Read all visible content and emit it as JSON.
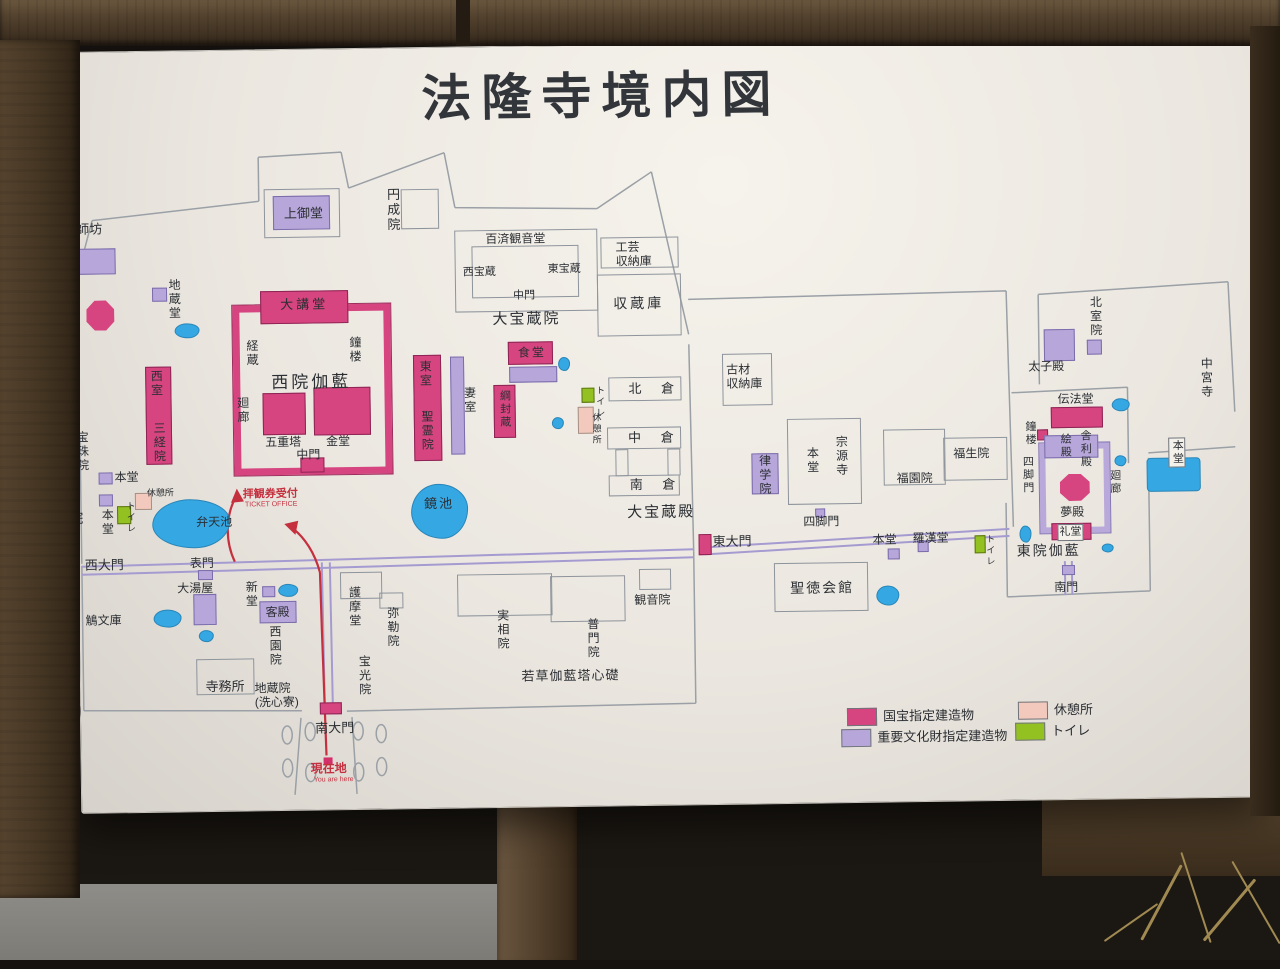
{
  "title": "法隆寺境内図",
  "compass": {
    "label": "N"
  },
  "annotations": {
    "ticket_office_jp": "拝観券受付",
    "ticket_office_en": "TICKET OFFICE",
    "you_are_here_jp": "現在地",
    "you_are_here_en": "You are here"
  },
  "legend": {
    "items": [
      {
        "x": 843,
        "y": 711,
        "color": "#d6457f",
        "label": "国宝指定建造物"
      },
      {
        "x": 837,
        "y": 732,
        "color": "#b6a6d9",
        "label": "重要文化財指定建造物"
      },
      {
        "x": 1014,
        "y": 707,
        "color": "#f2c9bc",
        "label": "休憩所"
      },
      {
        "x": 1011,
        "y": 728,
        "color": "#94c122",
        "label": "トイレ"
      }
    ]
  },
  "map": {
    "colors": {
      "national_treasure": "#d6457f",
      "important_cultural_property": "#b6a6d9",
      "rest_area": "#f2c9bc",
      "toilet": "#94c122",
      "pond": "#35a7e3",
      "annotation_red": "#c5303f"
    },
    "shapes": [
      {
        "x": 88,
        "y": 293,
        "w": 28,
        "h": 30,
        "f": "pink",
        "oct": true
      },
      {
        "x": 262,
        "y": 286,
        "w": 88,
        "h": 33,
        "f": "pink"
      },
      {
        "x": 234,
        "y": 300,
        "w": 158,
        "h": 170,
        "f": "pinkring"
      },
      {
        "x": 263,
        "y": 388,
        "w": 43,
        "h": 42,
        "f": "pink"
      },
      {
        "x": 314,
        "y": 383,
        "w": 57,
        "h": 48,
        "f": "pink"
      },
      {
        "x": 300,
        "y": 453,
        "w": 24,
        "h": 15,
        "f": "pink"
      },
      {
        "x": 146,
        "y": 360,
        "w": 26,
        "h": 98,
        "f": "pink"
      },
      {
        "x": 414,
        "y": 352,
        "w": 28,
        "h": 106,
        "f": "pink"
      },
      {
        "x": 509,
        "y": 340,
        "w": 45,
        "h": 23,
        "f": "pink"
      },
      {
        "x": 494,
        "y": 383,
        "w": 22,
        "h": 53,
        "f": "pink"
      },
      {
        "x": 697,
        "y": 535,
        "w": 13,
        "h": 21,
        "f": "pink"
      },
      {
        "x": 1051,
        "y": 413,
        "w": 52,
        "h": 21,
        "f": "pink"
      },
      {
        "x": 1059,
        "y": 480,
        "w": 30,
        "h": 27,
        "f": "pink",
        "oct": true
      },
      {
        "x": 1050,
        "y": 529,
        "w": 40,
        "h": 17,
        "f": "pink"
      },
      {
        "x": 316,
        "y": 698,
        "w": 22,
        "h": 12,
        "f": "pink"
      },
      {
        "x": 1037,
        "y": 435,
        "w": 11,
        "h": 11,
        "f": "pink"
      },
      {
        "x": 319,
        "y": 753,
        "w": 9,
        "h": 7,
        "f": "red"
      },
      {
        "x": 72,
        "y": 241,
        "w": 46,
        "h": 26,
        "f": "purple"
      },
      {
        "x": 154,
        "y": 281,
        "w": 15,
        "h": 14,
        "f": "purple"
      },
      {
        "x": 276,
        "y": 191,
        "w": 57,
        "h": 34,
        "f": "purple"
      },
      {
        "x": 191,
        "y": 588,
        "w": 23,
        "h": 31,
        "f": "purple"
      },
      {
        "x": 260,
        "y": 581,
        "w": 13,
        "h": 11,
        "f": "purple"
      },
      {
        "x": 257,
        "y": 596,
        "w": 37,
        "h": 22,
        "f": "purple"
      },
      {
        "x": 451,
        "y": 354,
        "w": 14,
        "h": 98,
        "f": "purple"
      },
      {
        "x": 510,
        "y": 365,
        "w": 48,
        "h": 16,
        "f": "purple"
      },
      {
        "x": 751,
        "y": 455,
        "w": 27,
        "h": 41,
        "f": "purple"
      },
      {
        "x": 98,
        "y": 465,
        "w": 14,
        "h": 12,
        "f": "purple"
      },
      {
        "x": 98,
        "y": 487,
        "w": 14,
        "h": 12,
        "f": "purple"
      },
      {
        "x": 196,
        "y": 564,
        "w": 15,
        "h": 10,
        "f": "purple"
      },
      {
        "x": 886,
        "y": 552,
        "w": 12,
        "h": 11,
        "f": "purple"
      },
      {
        "x": 916,
        "y": 545,
        "w": 11,
        "h": 11,
        "f": "purple"
      },
      {
        "x": 814,
        "y": 511,
        "w": 10,
        "h": 9,
        "f": "purple"
      },
      {
        "x": 1045,
        "y": 335,
        "w": 31,
        "h": 32,
        "f": "purple"
      },
      {
        "x": 1088,
        "y": 346,
        "w": 15,
        "h": 15,
        "f": "purple"
      },
      {
        "x": 1044,
        "y": 441,
        "w": 54,
        "h": 23,
        "f": "purple"
      },
      {
        "x": 1039,
        "y": 449,
        "w": 70,
        "h": 90,
        "f": "purplering"
      },
      {
        "x": 1060,
        "y": 571,
        "w": 13,
        "h": 10,
        "f": "purple"
      },
      {
        "x": 134,
        "y": 486,
        "w": 17,
        "h": 17,
        "f": "rest"
      },
      {
        "x": 578,
        "y": 406,
        "w": 16,
        "h": 27,
        "f": "rest"
      },
      {
        "x": 116,
        "y": 499,
        "w": 14,
        "h": 18,
        "f": "green"
      },
      {
        "x": 582,
        "y": 387,
        "w": 13,
        "h": 15,
        "f": "green"
      },
      {
        "x": 973,
        "y": 540,
        "w": 11,
        "h": 18,
        "f": "green"
      },
      {
        "x": 151,
        "y": 493,
        "w": 78,
        "h": 49,
        "f": "pond"
      },
      {
        "x": 410,
        "y": 481,
        "w": 57,
        "h": 55,
        "f": "pond"
      },
      {
        "x": 176,
        "y": 317,
        "w": 25,
        "h": 15,
        "f": "pond"
      },
      {
        "x": 276,
        "y": 579,
        "w": 20,
        "h": 13,
        "f": "pond"
      },
      {
        "x": 151,
        "y": 603,
        "w": 28,
        "h": 18,
        "f": "pond"
      },
      {
        "x": 196,
        "y": 624,
        "w": 15,
        "h": 12,
        "f": "pond"
      },
      {
        "x": 559,
        "y": 356,
        "w": 12,
        "h": 14,
        "f": "pond"
      },
      {
        "x": 552,
        "y": 416,
        "w": 12,
        "h": 12,
        "f": "pond"
      },
      {
        "x": 874,
        "y": 589,
        "w": 23,
        "h": 20,
        "f": "pond"
      },
      {
        "x": 1112,
        "y": 405,
        "w": 18,
        "h": 13,
        "f": "pond"
      },
      {
        "x": 1114,
        "y": 462,
        "w": 12,
        "h": 11,
        "f": "pond"
      },
      {
        "x": 1018,
        "y": 531,
        "w": 12,
        "h": 17,
        "f": "pond"
      },
      {
        "x": 1100,
        "y": 550,
        "w": 12,
        "h": 9,
        "f": "pond"
      },
      {
        "x": 1146,
        "y": 465,
        "w": 54,
        "h": 34,
        "f": "pond",
        "sq": true
      },
      {
        "x": 457,
        "y": 228,
        "w": 143,
        "h": 82,
        "f": "outline"
      },
      {
        "x": 474,
        "y": 244,
        "w": 107,
        "h": 52,
        "f": "outline"
      },
      {
        "x": 603,
        "y": 237,
        "w": 78,
        "h": 31,
        "f": "outline"
      },
      {
        "x": 599,
        "y": 274,
        "w": 84,
        "h": 62,
        "f": "outline"
      },
      {
        "x": 609,
        "y": 377,
        "w": 73,
        "h": 24,
        "f": "outline"
      },
      {
        "x": 607,
        "y": 427,
        "w": 74,
        "h": 22,
        "f": "outline"
      },
      {
        "x": 608,
        "y": 475,
        "w": 71,
        "h": 21,
        "f": "outline"
      },
      {
        "x": 615,
        "y": 449,
        "w": 13,
        "h": 27,
        "f": "outline"
      },
      {
        "x": 667,
        "y": 449,
        "w": 13,
        "h": 27,
        "f": "outline"
      },
      {
        "x": 723,
        "y": 355,
        "w": 50,
        "h": 52,
        "f": "outline"
      },
      {
        "x": 787,
        "y": 421,
        "w": 74,
        "h": 86,
        "f": "outline"
      },
      {
        "x": 883,
        "y": 433,
        "w": 62,
        "h": 56,
        "f": "outline"
      },
      {
        "x": 943,
        "y": 442,
        "w": 64,
        "h": 43,
        "f": "outline"
      },
      {
        "x": 772,
        "y": 565,
        "w": 94,
        "h": 49,
        "f": "outline"
      },
      {
        "x": 637,
        "y": 569,
        "w": 32,
        "h": 21,
        "f": "outline"
      },
      {
        "x": 404,
        "y": 186,
        "w": 38,
        "h": 40,
        "f": "outline"
      },
      {
        "x": 267,
        "y": 184,
        "w": 76,
        "h": 49,
        "f": "outline"
      },
      {
        "x": 338,
        "y": 568,
        "w": 42,
        "h": 27,
        "f": "outline"
      },
      {
        "x": 377,
        "y": 589,
        "w": 24,
        "h": 16,
        "f": "outline"
      },
      {
        "x": 455,
        "y": 572,
        "w": 95,
        "h": 42,
        "f": "outline"
      },
      {
        "x": 548,
        "y": 575,
        "w": 75,
        "h": 46,
        "f": "outline"
      },
      {
        "x": 193,
        "y": 653,
        "w": 58,
        "h": 36,
        "f": "outline"
      }
    ],
    "labels": [
      {
        "t": "薬師坊",
        "x": 66,
        "y": 214,
        "s": 13
      },
      {
        "t": "西円堂",
        "x": 61,
        "y": 283,
        "v": true
      },
      {
        "t": "地蔵堂",
        "x": 169,
        "y": 272,
        "v": true
      },
      {
        "t": "上御堂",
        "x": 287,
        "y": 201,
        "s": 13
      },
      {
        "t": "円成院",
        "x": 388,
        "y": 184,
        "v": true,
        "s": 13
      },
      {
        "t": "百済観音堂",
        "x": 488,
        "y": 230,
        "s": 12
      },
      {
        "t": "西宝蔵",
        "x": 465,
        "y": 264,
        "s": 11
      },
      {
        "t": "東宝蔵",
        "x": 550,
        "y": 262,
        "s": 11
      },
      {
        "t": "中門",
        "x": 515,
        "y": 288,
        "s": 11
      },
      {
        "t": "大宝蔵院",
        "x": 494,
        "y": 309,
        "s": 15,
        "ls": 2
      },
      {
        "t": "工芸\n収納庫",
        "x": 618,
        "y": 240,
        "s": 12
      },
      {
        "t": "収蔵庫",
        "x": 615,
        "y": 295,
        "s": 14,
        "ls": 3
      },
      {
        "t": "大講堂",
        "x": 282,
        "y": 292,
        "s": 13,
        "ls": 3
      },
      {
        "t": "経蔵",
        "x": 246,
        "y": 334,
        "v": true
      },
      {
        "t": "鐘楼",
        "x": 349,
        "y": 332,
        "v": true
      },
      {
        "t": "西院伽藍",
        "x": 272,
        "y": 368,
        "s": 17,
        "ls": 3
      },
      {
        "t": "廻廊",
        "x": 236,
        "y": 391,
        "v": true
      },
      {
        "t": "五重塔",
        "x": 265,
        "y": 430,
        "s": 12
      },
      {
        "t": "金堂",
        "x": 326,
        "y": 430,
        "s": 12
      },
      {
        "t": "中門",
        "x": 296,
        "y": 443,
        "s": 12
      },
      {
        "t": "西室",
        "x": 150,
        "y": 363,
        "v": true,
        "s": 12
      },
      {
        "t": "三経院",
        "x": 152,
        "y": 415,
        "v": true,
        "s": 12
      },
      {
        "t": "東室",
        "x": 419,
        "y": 357,
        "v": true,
        "s": 12
      },
      {
        "t": "聖霊院",
        "x": 420,
        "y": 407,
        "v": true,
        "s": 12
      },
      {
        "t": "妻室",
        "x": 463,
        "y": 384,
        "v": true,
        "s": 12
      },
      {
        "t": "食堂",
        "x": 519,
        "y": 344,
        "s": 12,
        "ls": 2
      },
      {
        "t": "綱封蔵",
        "x": 498,
        "y": 388,
        "v": true,
        "s": 11
      },
      {
        "t": "休憩所",
        "x": 591,
        "y": 412,
        "v": true,
        "s": 9
      },
      {
        "t": "トイレ",
        "x": 595,
        "y": 385,
        "v": true,
        "s": 9
      },
      {
        "t": "北 倉",
        "x": 629,
        "y": 381,
        "s": 13,
        "ls": 8
      },
      {
        "t": "中 倉",
        "x": 628,
        "y": 430,
        "s": 13,
        "ls": 8
      },
      {
        "t": "南 倉",
        "x": 629,
        "y": 477,
        "s": 13,
        "ls": 8
      },
      {
        "t": "大宝蔵殿",
        "x": 626,
        "y": 504,
        "s": 15,
        "ls": 2
      },
      {
        "t": "古材\n収納庫",
        "x": 727,
        "y": 364,
        "s": 12
      },
      {
        "t": "律学院",
        "x": 757,
        "y": 456,
        "v": true,
        "s": 12
      },
      {
        "t": "本堂",
        "x": 805,
        "y": 449,
        "v": true,
        "s": 12
      },
      {
        "t": "宗源寺",
        "x": 834,
        "y": 438,
        "v": true,
        "s": 12
      },
      {
        "t": "福園院",
        "x": 896,
        "y": 475,
        "s": 12
      },
      {
        "t": "福生院",
        "x": 953,
        "y": 451,
        "s": 12
      },
      {
        "t": "四脚門",
        "x": 802,
        "y": 517,
        "s": 12
      },
      {
        "t": "東大門",
        "x": 711,
        "y": 535,
        "s": 13
      },
      {
        "t": "本堂",
        "x": 871,
        "y": 536,
        "s": 12
      },
      {
        "t": "羅漢堂",
        "x": 911,
        "y": 535,
        "s": 12
      },
      {
        "t": "トイレ",
        "x": 983,
        "y": 539,
        "v": true,
        "s": 9
      },
      {
        "t": "聖徳会館",
        "x": 788,
        "y": 582,
        "s": 14,
        "ls": 2
      },
      {
        "t": "伝法堂",
        "x": 1058,
        "y": 398,
        "s": 12
      },
      {
        "t": "鐘楼",
        "x": 1023,
        "y": 426,
        "v": true,
        "s": 11
      },
      {
        "t": "絵殿",
        "x": 1058,
        "y": 439,
        "v": true,
        "s": 11
      },
      {
        "t": "舎利殿",
        "x": 1078,
        "y": 436,
        "v": true,
        "s": 11
      },
      {
        "t": "四脚門",
        "x": 1020,
        "y": 461,
        "v": true,
        "s": 11
      },
      {
        "t": "夢殿",
        "x": 1059,
        "y": 511,
        "s": 12
      },
      {
        "t": "礼堂",
        "x": 1056,
        "y": 530,
        "s": 11,
        "b": true
      },
      {
        "t": "廻廊",
        "x": 1107,
        "y": 476,
        "v": true,
        "s": 11
      },
      {
        "t": "東院伽藍",
        "x": 1015,
        "y": 548,
        "s": 14,
        "ls": 2
      },
      {
        "t": "南門",
        "x": 1052,
        "y": 586,
        "s": 12
      },
      {
        "t": "北室院",
        "x": 1090,
        "y": 302,
        "v": true,
        "s": 12
      },
      {
        "t": "太子殿",
        "x": 1029,
        "y": 365,
        "s": 12
      },
      {
        "t": "中宮寺",
        "x": 1200,
        "y": 365,
        "v": true,
        "s": 12
      },
      {
        "t": "本堂",
        "x": 1168,
        "y": 445,
        "v": true,
        "s": 11,
        "b": true
      },
      {
        "t": "宝珠院",
        "x": 75,
        "y": 423,
        "v": true,
        "s": 12
      },
      {
        "t": "本堂",
        "x": 114,
        "y": 463,
        "s": 12
      },
      {
        "t": "中院",
        "x": 54,
        "y": 502,
        "s": 14
      },
      {
        "t": "本堂",
        "x": 99,
        "y": 501,
        "v": true,
        "s": 12
      },
      {
        "t": "休憩所",
        "x": 146,
        "y": 481,
        "s": 9
      },
      {
        "t": "トイレ",
        "x": 124,
        "y": 494,
        "v": true,
        "s": 9
      },
      {
        "t": "弁天池",
        "x": 195,
        "y": 509,
        "s": 12
      },
      {
        "t": "鏡池",
        "x": 423,
        "y": 493,
        "s": 13,
        "ls": 2
      },
      {
        "t": "西大門",
        "x": 83,
        "y": 550,
        "s": 13
      },
      {
        "t": "表門",
        "x": 188,
        "y": 550,
        "s": 12
      },
      {
        "t": "大湯屋",
        "x": 175,
        "y": 575,
        "s": 12
      },
      {
        "t": "新堂",
        "x": 242,
        "y": 575,
        "v": true,
        "s": 12
      },
      {
        "t": "客殿",
        "x": 263,
        "y": 600,
        "s": 12
      },
      {
        "t": "西園院",
        "x": 265,
        "y": 620,
        "v": true,
        "s": 12
      },
      {
        "t": "鵤文庫",
        "x": 83,
        "y": 606,
        "s": 12
      },
      {
        "t": "寺務所",
        "x": 202,
        "y": 673,
        "s": 13
      },
      {
        "t": "地蔵院\n(洗心寮)",
        "x": 251,
        "y": 676,
        "s": 12
      },
      {
        "t": "護摩堂",
        "x": 345,
        "y": 582,
        "v": true,
        "s": 12
      },
      {
        "t": "弥勒院",
        "x": 383,
        "y": 603,
        "v": true,
        "s": 12
      },
      {
        "t": "宝光院",
        "x": 354,
        "y": 651,
        "v": true,
        "s": 12
      },
      {
        "t": "実相院",
        "x": 493,
        "y": 607,
        "v": true,
        "s": 12
      },
      {
        "t": "普門院",
        "x": 583,
        "y": 617,
        "v": true,
        "s": 12
      },
      {
        "t": "観音院",
        "x": 632,
        "y": 593,
        "s": 12
      },
      {
        "t": "若草伽藍塔心礎",
        "x": 518,
        "y": 667,
        "s": 13,
        "ls": 1
      },
      {
        "t": "南大門",
        "x": 311,
        "y": 716,
        "s": 13
      },
      {
        "t": "現在地",
        "x": 306,
        "y": 757,
        "s": 12,
        "c": "red",
        "bold": true
      },
      {
        "t": "You are here",
        "x": 309,
        "y": 772,
        "s": 7,
        "c": "red"
      },
      {
        "t": "拝観券受付",
        "x": 242,
        "y": 483,
        "s": 11,
        "c": "red",
        "bold": true
      },
      {
        "t": "TICKET OFFICE",
        "x": 244,
        "y": 496,
        "s": 7,
        "c": "red"
      }
    ]
  }
}
